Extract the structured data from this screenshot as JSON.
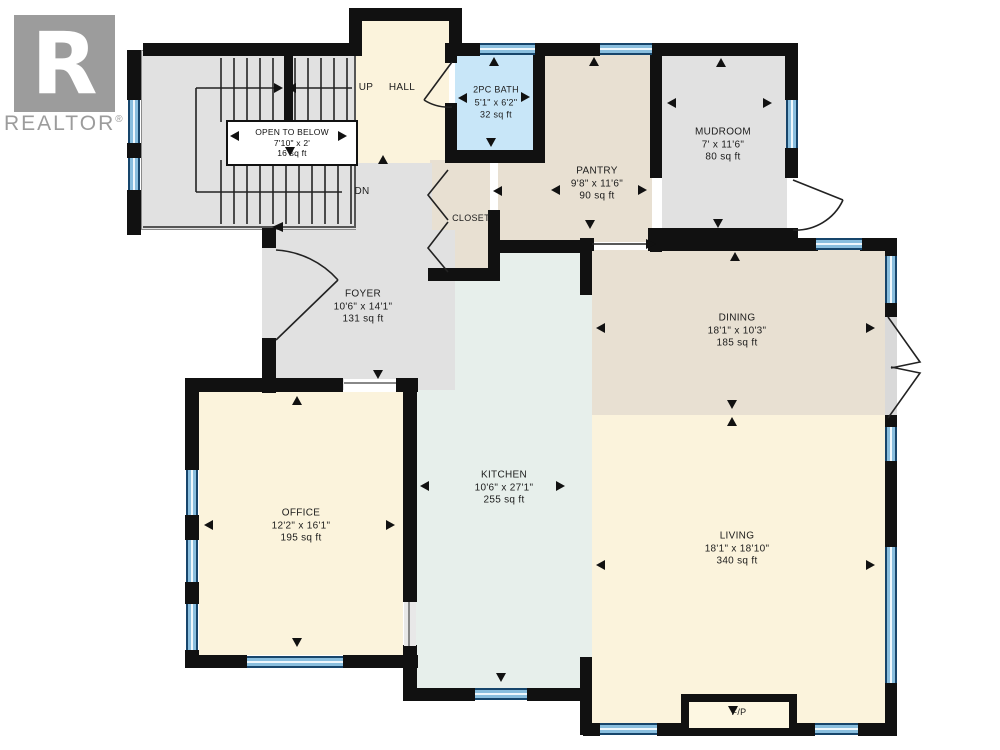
{
  "brand": {
    "logo_letter": "R",
    "logo_text": "REALTOR",
    "registered_mark": "®"
  },
  "stairs": {
    "up_label": "UP",
    "down_label": "DN",
    "open_to_below": {
      "name": "OPEN TO BELOW",
      "dims": "7'10\" x 2'",
      "area": "16 sq ft"
    }
  },
  "rooms": {
    "hall": {
      "name": "HALL"
    },
    "bath": {
      "name": "2PC BATH",
      "dims": "5'1\" x 6'2\"",
      "area": "32 sq ft"
    },
    "pantry": {
      "name": "PANTRY",
      "dims": "9'8\" x 11'6\"",
      "area": "90 sq ft"
    },
    "mudroom": {
      "name": "MUDROOM",
      "dims": "7' x 11'6\"",
      "area": "80 sq ft"
    },
    "closet": {
      "name": "CLOSET"
    },
    "foyer": {
      "name": "FOYER",
      "dims": "10'6\" x 14'1\"",
      "area": "131 sq ft"
    },
    "dining": {
      "name": "DINING",
      "dims": "18'1\" x 10'3\"",
      "area": "185 sq ft"
    },
    "office": {
      "name": "OFFICE",
      "dims": "12'2\" x 16'1\"",
      "area": "195 sq ft"
    },
    "kitchen": {
      "name": "KITCHEN",
      "dims": "10'6\" x 27'1\"",
      "area": "255 sq ft"
    },
    "living": {
      "name": "LIVING",
      "dims": "18'1\" x 18'10\"",
      "area": "340 sq ft"
    },
    "fireplace": {
      "name": "F/P"
    }
  },
  "colors": {
    "wall": "#111111",
    "room_cream": "#FBF3DC",
    "room_tan": "#E8E0D2",
    "room_gray": "#E1E1E1",
    "room_bath_blue": "#C8E6F8",
    "room_kitchen_teal": "#E7EFEB",
    "window_blue": "#89BEDE",
    "window_frame": "#17456B",
    "logo_gray": "#9C9C9C"
  }
}
